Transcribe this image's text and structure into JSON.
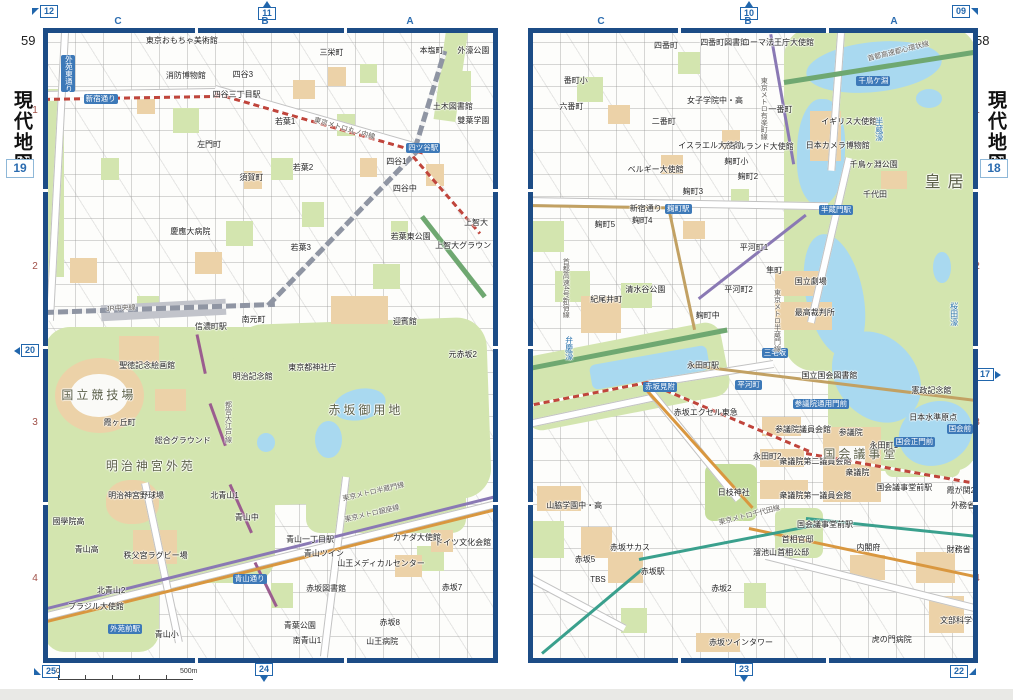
{
  "spread": {
    "left_page": {
      "page_number": "59",
      "sidebar_title": "現代地図",
      "map_number": "19",
      "columns": [
        "C",
        "B",
        "A"
      ],
      "rows": [
        "1",
        "2",
        "3",
        "4"
      ],
      "markers": {
        "top_left": "12",
        "top": "11",
        "left": "20",
        "bottom_left": "25",
        "bottom": "24"
      },
      "scale": {
        "zero": "0",
        "label": "500m"
      },
      "labels": [
        {
          "t": "東京おもちゃ美術館",
          "x": 22,
          "y": 0.6,
          "k": "p"
        },
        {
          "t": "四谷3",
          "x": 41.5,
          "y": 6.0,
          "k": "p"
        },
        {
          "t": "消防博物館",
          "x": 26.5,
          "y": 6.2,
          "k": "p"
        },
        {
          "t": "三栄町",
          "x": 61,
          "y": 2.6,
          "k": "p"
        },
        {
          "t": "本塩町",
          "x": 83.5,
          "y": 2.2,
          "k": "p"
        },
        {
          "t": "外濠公園",
          "x": 92,
          "y": 2.2,
          "k": "p"
        },
        {
          "t": "四谷三丁目駅",
          "x": 37,
          "y": 9.2,
          "k": "p"
        },
        {
          "t": "新宿通り",
          "x": 8,
          "y": 9.8,
          "k": "s"
        },
        {
          "t": "外苑東通り",
          "x": 3,
          "y": 3.5,
          "k": "s",
          "v": true
        },
        {
          "t": "左門町",
          "x": 33.5,
          "y": 17.2,
          "k": "p"
        },
        {
          "t": "須賀町",
          "x": 43,
          "y": 22.6,
          "k": "p"
        },
        {
          "t": "若葉1",
          "x": 51,
          "y": 13.6,
          "k": "p"
        },
        {
          "t": "若葉2",
          "x": 55,
          "y": 20.9,
          "k": "p"
        },
        {
          "t": "若葉3",
          "x": 54.5,
          "y": 33.8,
          "k": "p"
        },
        {
          "t": "若葉東公園",
          "x": 77,
          "y": 32,
          "k": "p"
        },
        {
          "t": "四谷1",
          "x": 76,
          "y": 20,
          "k": "p"
        },
        {
          "t": "四谷中",
          "x": 77.5,
          "y": 24.3,
          "k": "p"
        },
        {
          "t": "雙葉学園",
          "x": 92,
          "y": 13.5,
          "k": "p"
        },
        {
          "t": "土木図書館",
          "x": 86.5,
          "y": 11.2,
          "k": "p"
        },
        {
          "t": "上智大",
          "x": 93.5,
          "y": 29.8,
          "k": "p"
        },
        {
          "t": "上智大グラウンド",
          "x": 87,
          "y": 33.5,
          "k": "p"
        },
        {
          "t": "四ツ谷駅",
          "x": 80.5,
          "y": 17.6,
          "k": "s"
        },
        {
          "t": "慶應大病院",
          "x": 27.5,
          "y": 31.2,
          "k": "p"
        },
        {
          "t": "信濃町駅",
          "x": 33,
          "y": 46.4,
          "k": "p"
        },
        {
          "t": "南元町",
          "x": 43.5,
          "y": 45.2,
          "k": "p"
        },
        {
          "t": "迎賓館",
          "x": 77.5,
          "y": 45.6,
          "k": "p"
        },
        {
          "t": "元赤坂2",
          "x": 90,
          "y": 50.8,
          "k": "p"
        },
        {
          "t": "東京都神社庁",
          "x": 54,
          "y": 52.9,
          "k": "p"
        },
        {
          "t": "赤坂御用地",
          "x": 63,
          "y": 59.4,
          "k": "b"
        },
        {
          "t": "聖徳記念絵画館",
          "x": 16,
          "y": 52.7,
          "k": "p"
        },
        {
          "t": "国立競技場",
          "x": 3,
          "y": 57,
          "k": "b"
        },
        {
          "t": "霞ヶ丘町",
          "x": 12.5,
          "y": 61.8,
          "k": "p"
        },
        {
          "t": "総合グラウンド",
          "x": 24,
          "y": 64.6,
          "k": "p"
        },
        {
          "t": "明治神宮外苑",
          "x": 13,
          "y": 68.3,
          "k": "b"
        },
        {
          "t": "明治記念館",
          "x": 41.5,
          "y": 54.4,
          "k": "p"
        },
        {
          "t": "明治神宮野球場",
          "x": 13.5,
          "y": 73.5,
          "k": "p"
        },
        {
          "t": "北青山1",
          "x": 36.5,
          "y": 73.5,
          "k": "p"
        },
        {
          "t": "青山中",
          "x": 42,
          "y": 76.9,
          "k": "p"
        },
        {
          "t": "國學院高",
          "x": 1,
          "y": 77.6,
          "k": "p"
        },
        {
          "t": "青山高",
          "x": 6,
          "y": 82.1,
          "k": "p"
        },
        {
          "t": "秩父宮ラグビー場",
          "x": 17,
          "y": 83,
          "k": "p"
        },
        {
          "t": "北青山2",
          "x": 11,
          "y": 88.6,
          "k": "p"
        },
        {
          "t": "ブラジル大使館",
          "x": 4.5,
          "y": 91.2,
          "k": "p"
        },
        {
          "t": "青山小",
          "x": 24,
          "y": 95.6,
          "k": "p"
        },
        {
          "t": "南青山1",
          "x": 55,
          "y": 96.6,
          "k": "p"
        },
        {
          "t": "青葉公園",
          "x": 53,
          "y": 94.2,
          "k": "p"
        },
        {
          "t": "カナダ大使館",
          "x": 77.5,
          "y": 80.2,
          "k": "p"
        },
        {
          "t": "ドイツ文化会館",
          "x": 87,
          "y": 80.9,
          "k": "p"
        },
        {
          "t": "山王メディカルセンター",
          "x": 65,
          "y": 84.3,
          "k": "p"
        },
        {
          "t": "赤坂図書館",
          "x": 58,
          "y": 88.3,
          "k": "p"
        },
        {
          "t": "赤坂7",
          "x": 88.5,
          "y": 88.2,
          "k": "p"
        },
        {
          "t": "赤坂8",
          "x": 74.5,
          "y": 93.8,
          "k": "p"
        },
        {
          "t": "山王病院",
          "x": 71.5,
          "y": 96.8,
          "k": "p"
        },
        {
          "t": "青山一丁目駅",
          "x": 53.5,
          "y": 80.4,
          "k": "p"
        },
        {
          "t": "青山ツイン",
          "x": 57.5,
          "y": 82.7,
          "k": "p"
        },
        {
          "t": "青山通り",
          "x": 41.5,
          "y": 86.5,
          "k": "s"
        },
        {
          "t": "外苑前駅",
          "x": 13.5,
          "y": 94.6,
          "k": "s"
        },
        {
          "t": "JR中央線",
          "x": 13,
          "y": 43.6,
          "k": "l",
          "r": -3
        },
        {
          "t": "東京メトロ丸ノ内線",
          "x": 60,
          "y": 13.4,
          "k": "l",
          "r": 16
        },
        {
          "t": "都営大江戸線",
          "x": 39.5,
          "y": 58.8,
          "k": "l",
          "v": true
        },
        {
          "t": "東京メトロ半蔵門線",
          "x": 66,
          "y": 74,
          "k": "l",
          "r": -13
        },
        {
          "t": "東京メトロ銀座線",
          "x": 66.5,
          "y": 77.4,
          "k": "l",
          "r": -13
        }
      ]
    },
    "right_page": {
      "page_number": "58",
      "sidebar_title": "現代地図",
      "map_number": "18",
      "columns": [
        "C",
        "B",
        "A"
      ],
      "rows": [
        "1",
        "2",
        "3",
        "4"
      ],
      "markers": {
        "top": "10",
        "top_right": "09",
        "right": "17",
        "bottom": "23",
        "bottom_right": "22"
      },
      "labels": [
        {
          "t": "四番町",
          "x": 27.5,
          "y": 1.4,
          "k": "p"
        },
        {
          "t": "四番町図書館",
          "x": 38,
          "y": 0.9,
          "k": "p"
        },
        {
          "t": "ローマ法王庁大使館",
          "x": 47.5,
          "y": 0.9,
          "k": "p"
        },
        {
          "t": "番町小",
          "x": 7,
          "y": 7,
          "k": "p"
        },
        {
          "t": "六番町",
          "x": 6,
          "y": 11.2,
          "k": "p"
        },
        {
          "t": "二番町",
          "x": 27,
          "y": 13.6,
          "k": "p"
        },
        {
          "t": "女子学院中・高",
          "x": 35,
          "y": 10.2,
          "k": "p"
        },
        {
          "t": "イスラエル大使館",
          "x": 33,
          "y": 17.5,
          "k": "p"
        },
        {
          "t": "アイルランド大使館",
          "x": 43,
          "y": 17.6,
          "k": "p"
        },
        {
          "t": "ベルギー大使館",
          "x": 21.5,
          "y": 21.3,
          "k": "p"
        },
        {
          "t": "麹町小",
          "x": 43.5,
          "y": 20,
          "k": "p"
        },
        {
          "t": "麹町2",
          "x": 46.5,
          "y": 22.4,
          "k": "p"
        },
        {
          "t": "麹町3",
          "x": 34,
          "y": 24.8,
          "k": "p"
        },
        {
          "t": "麹町4",
          "x": 22.5,
          "y": 29.4,
          "k": "p"
        },
        {
          "t": "麹町5",
          "x": 14,
          "y": 30.1,
          "k": "p"
        },
        {
          "t": "麹町駅",
          "x": 30,
          "y": 27.3,
          "k": "s"
        },
        {
          "t": "新宿通り",
          "x": 22,
          "y": 27.5,
          "k": "p"
        },
        {
          "t": "平河町1",
          "x": 47,
          "y": 33.8,
          "k": "p"
        },
        {
          "t": "平河町2",
          "x": 43.5,
          "y": 40.5,
          "k": "p"
        },
        {
          "t": "イギリス大使館",
          "x": 65.5,
          "y": 13.6,
          "k": "p"
        },
        {
          "t": "日本カメラ博物館",
          "x": 62,
          "y": 17.5,
          "k": "p"
        },
        {
          "t": "一番町",
          "x": 53.5,
          "y": 11.7,
          "k": "p"
        },
        {
          "t": "半蔵門駅",
          "x": 65,
          "y": 27.5,
          "k": "s"
        },
        {
          "t": "半蔵濠",
          "x": 77.5,
          "y": 13.5,
          "k": "w",
          "v": true
        },
        {
          "t": "千鳥ヶ淵公園",
          "x": 72,
          "y": 20.5,
          "k": "p"
        },
        {
          "t": "千代田",
          "x": 75,
          "y": 25.3,
          "k": "p"
        },
        {
          "t": "皇居",
          "x": 89,
          "y": 22.5,
          "k": "g"
        },
        {
          "t": "千鳥ケ淵",
          "x": 73.5,
          "y": 6.8,
          "k": "s"
        },
        {
          "t": "首都高速都心環状線",
          "x": 76,
          "y": 3.6,
          "k": "l",
          "r": -14
        },
        {
          "t": "国立劇場",
          "x": 59.5,
          "y": 39.2,
          "k": "p"
        },
        {
          "t": "最高裁判所",
          "x": 59.5,
          "y": 44.1,
          "k": "p"
        },
        {
          "t": "桜田濠",
          "x": 94.5,
          "y": 43,
          "k": "w",
          "v": true
        },
        {
          "t": "三宅坂",
          "x": 52,
          "y": 50.4,
          "k": "s"
        },
        {
          "t": "紀尾井町",
          "x": 13,
          "y": 42,
          "k": "p"
        },
        {
          "t": "清水谷公園",
          "x": 21,
          "y": 40.4,
          "k": "p"
        },
        {
          "t": "麹町中",
          "x": 37,
          "y": 44.7,
          "k": "p"
        },
        {
          "t": "弁慶濠",
          "x": 7,
          "y": 48.5,
          "k": "w",
          "v": true
        },
        {
          "t": "永田町駅",
          "x": 35,
          "y": 52.7,
          "k": "p"
        },
        {
          "t": "赤坂見附",
          "x": 25,
          "y": 55.8,
          "k": "s"
        },
        {
          "t": "平河町",
          "x": 46,
          "y": 55.5,
          "k": "s"
        },
        {
          "t": "赤坂エクセル東急",
          "x": 32,
          "y": 60.2,
          "k": "p"
        },
        {
          "t": "首都高速4号新宿線",
          "x": 6.5,
          "y": 36,
          "k": "l",
          "v": true
        },
        {
          "t": "東京メトロ半蔵門線",
          "x": 54.5,
          "y": 41,
          "k": "l",
          "v": true
        },
        {
          "t": "東京メトロ有楽町線",
          "x": 51.5,
          "y": 7,
          "k": "l",
          "v": true
        },
        {
          "t": "隼町",
          "x": 53,
          "y": 37.4,
          "k": "p"
        },
        {
          "t": "永田町2",
          "x": 50,
          "y": 67.2,
          "k": "p"
        },
        {
          "t": "参議院議員会館",
          "x": 55,
          "y": 62.8,
          "k": "p"
        },
        {
          "t": "衆議院第二議員会館",
          "x": 56,
          "y": 68,
          "k": "p"
        },
        {
          "t": "衆議院第一議員会館",
          "x": 56,
          "y": 73.5,
          "k": "p"
        },
        {
          "t": "国会議事堂",
          "x": 66,
          "y": 66.4,
          "k": "b"
        },
        {
          "t": "参議院",
          "x": 69.5,
          "y": 63.4,
          "k": "p"
        },
        {
          "t": "衆議院",
          "x": 71,
          "y": 69.8,
          "k": "p"
        },
        {
          "t": "永田町1",
          "x": 76.5,
          "y": 65.4,
          "k": "p"
        },
        {
          "t": "国会議事堂前駅",
          "x": 78,
          "y": 72.1,
          "k": "p"
        },
        {
          "t": "国会議事堂前駅",
          "x": 60,
          "y": 78.1,
          "k": "p"
        },
        {
          "t": "参議院通用門前",
          "x": 59,
          "y": 58.6,
          "k": "s"
        },
        {
          "t": "国会正門前",
          "x": 82,
          "y": 64.7,
          "k": "s"
        },
        {
          "t": "憲政記念館",
          "x": 86,
          "y": 56.6,
          "k": "p"
        },
        {
          "t": "日本水準原点",
          "x": 85.5,
          "y": 61,
          "k": "p"
        },
        {
          "t": "国会前",
          "x": 94,
          "y": 62.6,
          "k": "s"
        },
        {
          "t": "国立国会図書館",
          "x": 61,
          "y": 54.2,
          "k": "p"
        },
        {
          "t": "霞が関2",
          "x": 94,
          "y": 72.7,
          "k": "p"
        },
        {
          "t": "外務省",
          "x": 95,
          "y": 75.1,
          "k": "p"
        },
        {
          "t": "財務省",
          "x": 94,
          "y": 82.1,
          "k": "p"
        },
        {
          "t": "溜池山王駅",
          "x": 50,
          "y": 82.6,
          "k": "p"
        },
        {
          "t": "首相官邸",
          "x": 56.5,
          "y": 80.4,
          "k": "p"
        },
        {
          "t": "首相公邸",
          "x": 55.5,
          "y": 82.6,
          "k": "p"
        },
        {
          "t": "内閣府",
          "x": 73.5,
          "y": 81.7,
          "k": "p"
        },
        {
          "t": "日枝神社",
          "x": 42,
          "y": 73,
          "k": "p"
        },
        {
          "t": "東京メトロ千代田線",
          "x": 42,
          "y": 77.9,
          "k": "l",
          "r": -14
        },
        {
          "t": "山脇学園中・高",
          "x": 3,
          "y": 75,
          "k": "p"
        },
        {
          "t": "赤坂サカス",
          "x": 17.5,
          "y": 81.7,
          "k": "p"
        },
        {
          "t": "赤坂5",
          "x": 9.5,
          "y": 83.6,
          "k": "p"
        },
        {
          "t": "TBS",
          "x": 13,
          "y": 86.9,
          "k": "p"
        },
        {
          "t": "赤坂駅",
          "x": 24.5,
          "y": 85.6,
          "k": "p"
        },
        {
          "t": "赤坂2",
          "x": 40.5,
          "y": 88.3,
          "k": "p"
        },
        {
          "t": "赤坂ツインタワー",
          "x": 40,
          "y": 97,
          "k": "p"
        },
        {
          "t": "虎の門病院",
          "x": 77,
          "y": 96.5,
          "k": "p"
        },
        {
          "t": "文部科学省",
          "x": 92.5,
          "y": 93.5,
          "k": "p"
        }
      ]
    }
  }
}
